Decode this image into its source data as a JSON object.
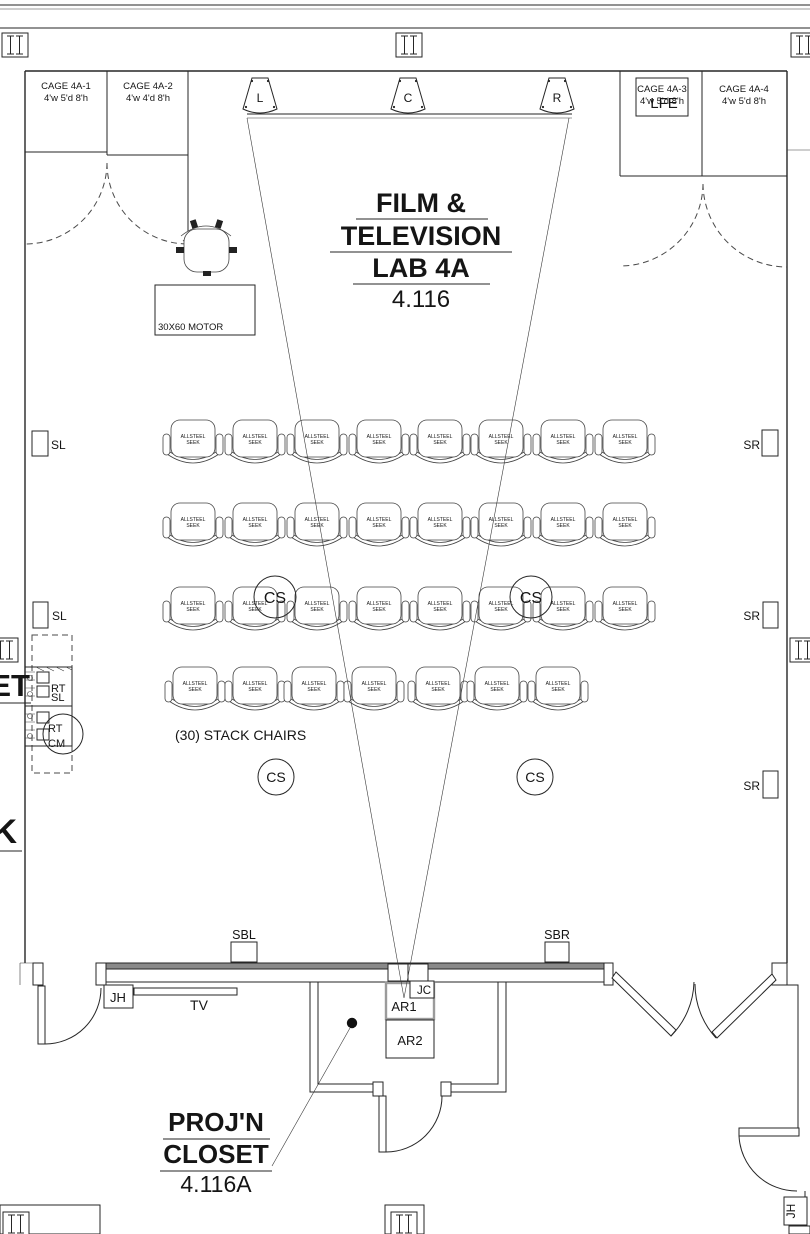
{
  "drawing": {
    "title": {
      "line1": "FILM &",
      "line2": "TELEVISION",
      "line3": "LAB 4A",
      "room": "4.116"
    },
    "closet": {
      "line1": "PROJ'N",
      "line2": "CLOSET",
      "room": "4.116A"
    },
    "cages": [
      {
        "name": "CAGE 4A-1",
        "dims": "4'w 5'd 8'h"
      },
      {
        "name": "CAGE 4A-2",
        "dims": "4'w 4'd 8'h"
      },
      {
        "name": "CAGE 4A-3",
        "dims": "4'w 5'd 8'h"
      },
      {
        "name": "CAGE 4A-4",
        "dims": "4'w 5'd 8'h"
      }
    ],
    "speakers": {
      "left": "L",
      "center": "C",
      "right": "R",
      "lfe": "LFE",
      "surround_left": "SL",
      "surround_right": "SR",
      "surround_back_left": "SBL",
      "surround_back_right": "SBR",
      "ceiling": "CS"
    },
    "labels": {
      "motor": "30X60 MOTOR",
      "stack_chairs_note": "(30) STACK CHAIRS",
      "jh": "JH",
      "tv": "TV",
      "jc": "JC",
      "ar1": "AR1",
      "ar2": "AR2",
      "rt": "RT",
      "cm": "CM",
      "sl": "SL",
      "et": "ET",
      "k": "K"
    },
    "seating": {
      "chair_brand_line1": "ALLSTEEL",
      "chair_brand_line2": "SEEK",
      "rows": [
        {
          "y": 445,
          "xs": [
            193,
            255,
            317,
            379,
            440,
            501,
            563,
            625
          ]
        },
        {
          "y": 528,
          "xs": [
            193,
            255,
            317,
            379,
            440,
            501,
            563,
            625
          ]
        },
        {
          "y": 612,
          "xs": [
            193,
            255,
            317,
            379,
            440,
            501,
            563,
            625
          ]
        },
        {
          "y": 692,
          "xs": [
            195,
            255,
            314,
            374,
            438,
            497,
            558
          ]
        }
      ]
    }
  }
}
